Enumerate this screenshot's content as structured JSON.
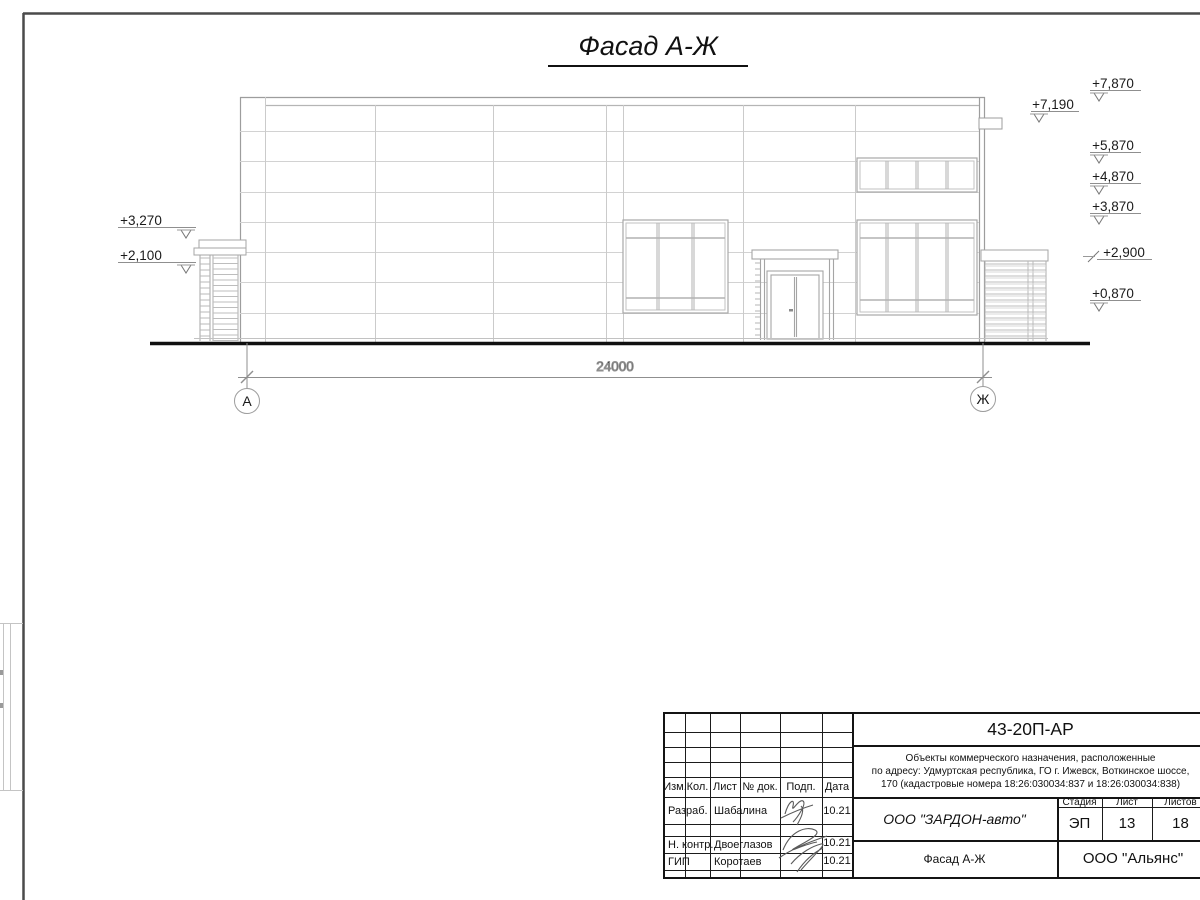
{
  "title": "Фасад А-Ж",
  "drawing": {
    "dimension_label": "24000",
    "axis_left": "А",
    "axis_right": "Ж",
    "elevation_marks_left": [
      {
        "label": "+3,270"
      },
      {
        "label": "+2,100"
      }
    ],
    "elevation_marks_right": [
      {
        "label": "+7,870"
      },
      {
        "label": "+7,190"
      },
      {
        "label": "+5,870"
      },
      {
        "label": "+4,870"
      },
      {
        "label": "+3,870"
      },
      {
        "label": "+2,900"
      },
      {
        "label": "+0,870"
      }
    ]
  },
  "title_block": {
    "doc_number": "43-20П-АР",
    "project_description_lines": [
      "Объекты коммерческого назначения, расположенные",
      "по адресу: Удмуртская республика, ГО г. Ижевск, Воткинское шоссе,",
      "170 (кадастровые номера 18:26:030034:837 и 18:26:030034:838)"
    ],
    "header_cols": [
      "Изм.",
      "Кол.",
      "Лист",
      "№ док.",
      "Подп.",
      "Дата"
    ],
    "rows": [
      {
        "role": "Разраб.",
        "name": "Шабалина",
        "date": "10.21"
      },
      {
        "role": "Н. контр.",
        "name": "Двоеглазов",
        "date": "10.21"
      },
      {
        "role": "ГИП",
        "name": "Коротаев",
        "date": "10.21"
      }
    ],
    "company": "ООО \"ЗАРДОН-авто\"",
    "stage_label": "Стадия",
    "sheet_label": "Лист",
    "sheets_label": "Листов",
    "stage": "ЭП",
    "sheet": "13",
    "sheets": "18",
    "sheet_title": "Фасад А-Ж",
    "contractor": "ООО \"Альянс\""
  }
}
